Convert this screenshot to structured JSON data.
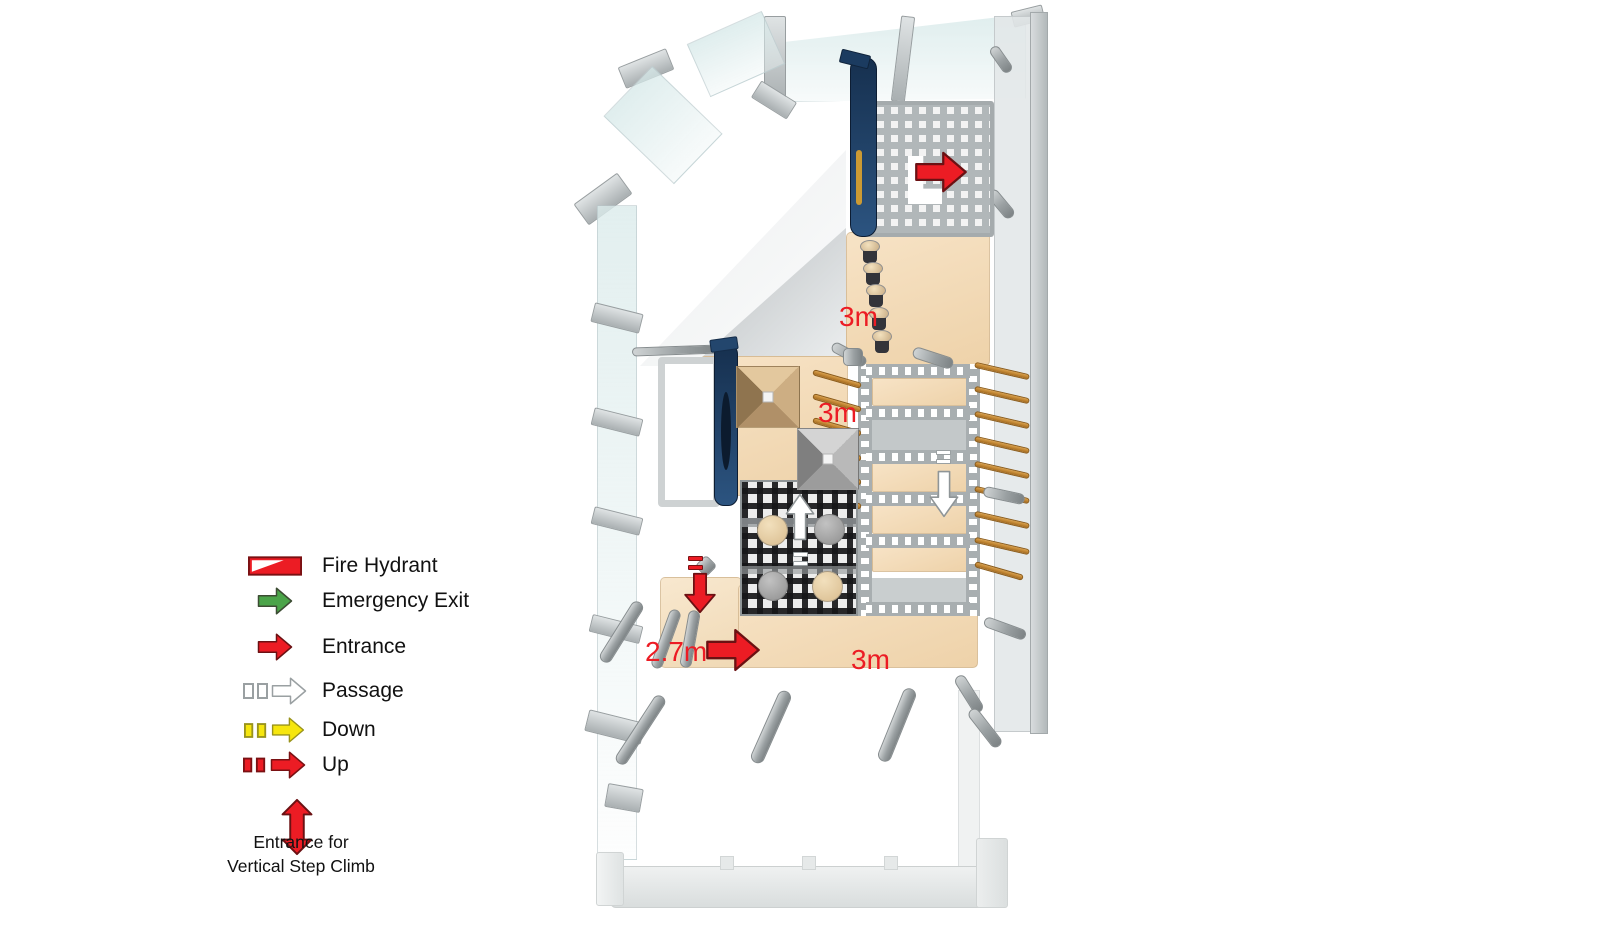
{
  "legend": {
    "items": [
      {
        "label": "Fire Hydrant"
      },
      {
        "label": "Emergency Exit"
      },
      {
        "label": "Entrance"
      },
      {
        "label": "Passage"
      },
      {
        "label": "Down"
      },
      {
        "label": "Up"
      }
    ],
    "vertical_climb": {
      "line1": "Entrance for",
      "line2": "Vertical Step Climb"
    }
  },
  "plan": {
    "dim_labels": [
      {
        "text": "3m"
      },
      {
        "text": "3m"
      },
      {
        "text": "2.7m"
      },
      {
        "text": "3m"
      }
    ]
  },
  "colors": {
    "entrance_red": "#ec1c24",
    "emergency_green": "#4ba449",
    "down_yellow": "#f6e60e",
    "passage_white": "#ffffff",
    "floor_tan": "#f0d7b4",
    "structure_grey": "#aab0b2",
    "slide_navy": "#1d3a5f",
    "rung_orange": "#c8862a",
    "glass_tint": "#dcebeb",
    "label_red": "#ec1c24"
  }
}
